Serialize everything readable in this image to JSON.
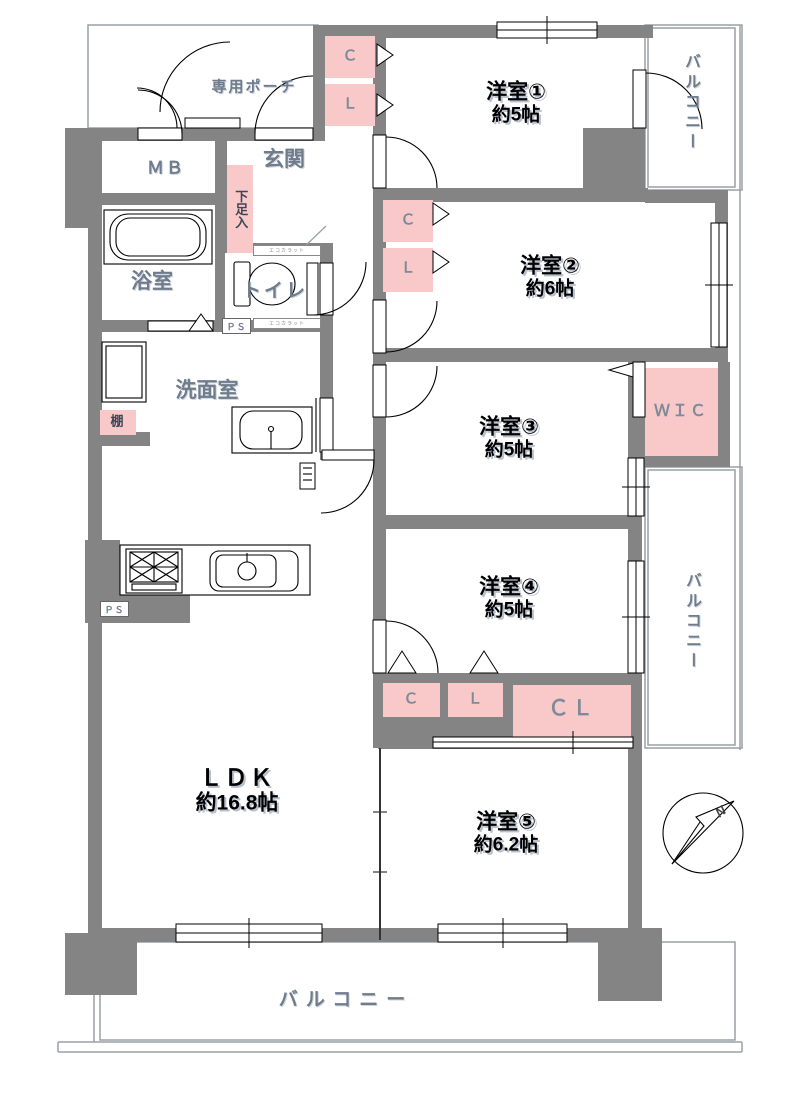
{
  "colors": {
    "wall": "#848484",
    "closet_pink": "#f9c9c9",
    "room_text": "#000000",
    "utility_text": "#6f7c8c",
    "thin_line": "#9aa0a6"
  },
  "rooms": [
    {
      "id": "yoshitsu1",
      "name": "洋室①",
      "size": "約5帖"
    },
    {
      "id": "yoshitsu2",
      "name": "洋室②",
      "size": "約6帖"
    },
    {
      "id": "yoshitsu3",
      "name": "洋室③",
      "size": "約5帖"
    },
    {
      "id": "yoshitsu4",
      "name": "洋室④",
      "size": "約5帖"
    },
    {
      "id": "yoshitsu5",
      "name": "洋室⑤",
      "size": "約6.2帖"
    },
    {
      "id": "ldk",
      "name": "ＬＤＫ",
      "size": "約16.8帖"
    }
  ],
  "balconies": {
    "top_right": "バルコニー",
    "right": "バルコニー",
    "bottom": "バルコニー"
  },
  "features": {
    "porch": "専用ポーチ",
    "meter_box": "ＭＢ",
    "entrance": "玄関",
    "shoe_cabinet": "下足入",
    "bathroom": "浴室",
    "toilet": "トイレ",
    "washroom": "洗面室",
    "shelf": "棚",
    "pipe_space": "ＰＳ",
    "wic": "ＷＩＣ",
    "ecocarat": "エコカラット",
    "closet_c": "Ｃ",
    "closet_l": "Ｌ",
    "closet_cl": "ＣＬ"
  },
  "compass": {
    "label": "N"
  }
}
